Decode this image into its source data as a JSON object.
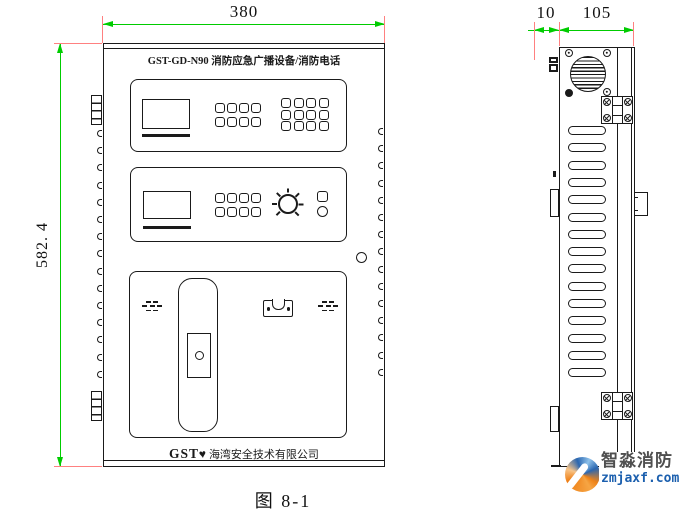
{
  "figure": {
    "caption": "图 8-1"
  },
  "dimensions": {
    "front_width": "380",
    "front_height": "582. 4",
    "side_mount_depth": "10",
    "side_body_depth": "105"
  },
  "front_view": {
    "model_label": "GST-GD-N90 消防应急广播设备/消防电话",
    "brand": "GST",
    "brand_mark": "♥",
    "company": "海湾安全技术有限公司",
    "panel1_keypad_small": {
      "rows": 2,
      "cols": 4
    },
    "panel1_keypad_large": {
      "rows": 3,
      "cols": 4
    },
    "panel2_keypad": {
      "rows": 2,
      "cols": 4
    },
    "knob_ticks": 7,
    "edge_bumps": 15,
    "grille_rows": [
      2,
      3,
      2
    ]
  },
  "side_view": {
    "louvers": 15
  },
  "watermark": {
    "title": "智淼消防",
    "site": "zmjaxf.com"
  },
  "colors": {
    "dimension_line": "#00cc00",
    "extension_line": "#ff8080",
    "drawing_line": "#1a1a1a",
    "watermark_orange": "#ee7f17",
    "watermark_blue": "#2a66b0",
    "watermark_text": "#4f4f4f",
    "watermark_site": "#1b5fae"
  }
}
